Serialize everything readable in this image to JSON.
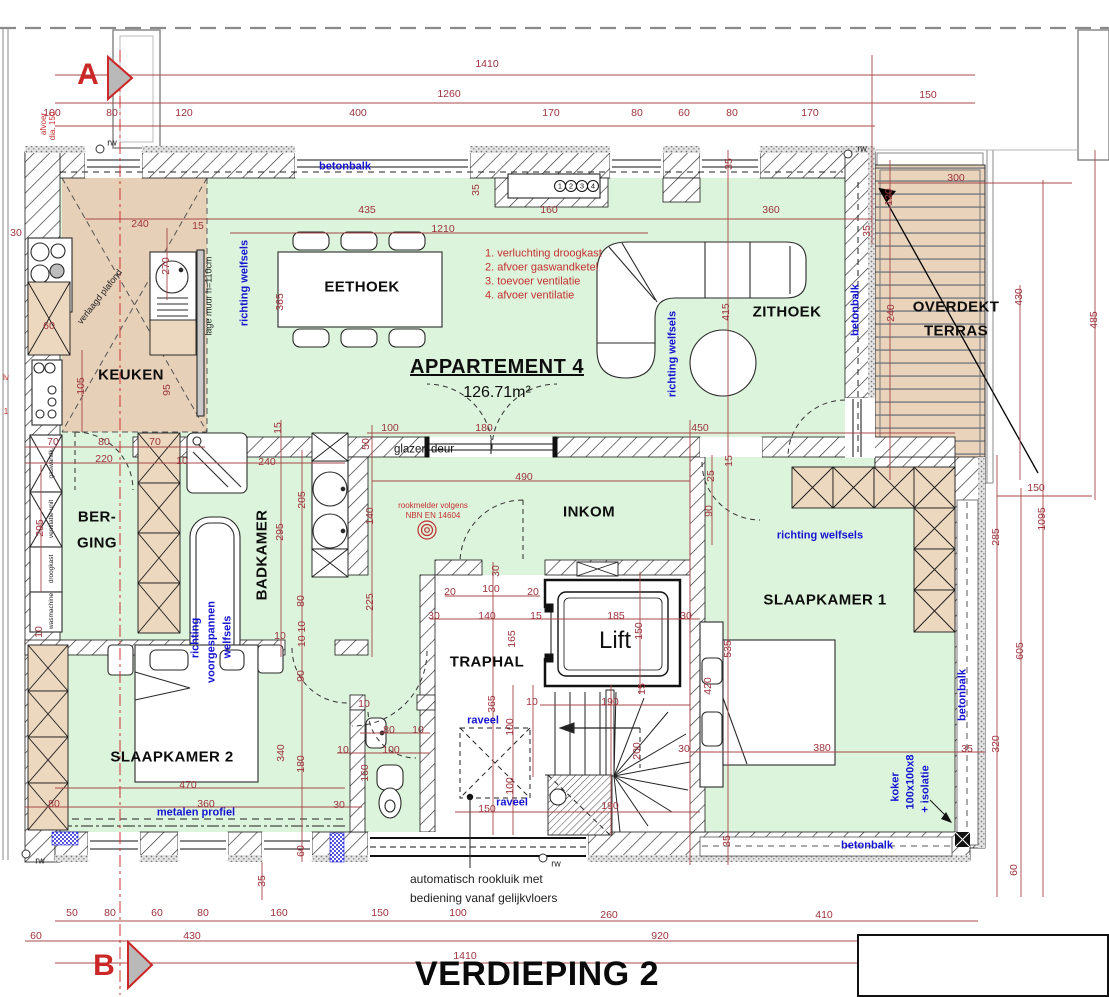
{
  "title": "VERDIEPING 2",
  "apartment": {
    "name": "APPARTEMENT 4",
    "area": "126.71m²"
  },
  "colors": {
    "dim_red": "#9d323c",
    "note_blue": "#1414d2",
    "room_green": "#dcf3dc",
    "cabinet_tan": "#ecd7bf",
    "marker_red": "#cc2727",
    "terrace_tan": "#e9d3bb"
  },
  "rooms": [
    "KEUKEN",
    "EETHOEK",
    "ZITHOEK",
    "BERGING",
    "BADKAMER",
    "INKOM",
    "TRAPHAL",
    "SLAAPKAMER 1",
    "SLAAPKAMER 2",
    "OVERDEKT TERRAS",
    "Lift"
  ],
  "legend_red": [
    "1. verluchting droogkast",
    "2. afvoer gaswandketel",
    "3. toevoer ventilatie",
    "4. afvoer ventilatie"
  ],
  "labels": [
    {
      "t": "1410",
      "x": 487,
      "y": 64,
      "c": "d"
    },
    {
      "t": "1260",
      "x": 449,
      "y": 94,
      "c": "d"
    },
    {
      "t": "150",
      "x": 928,
      "y": 95,
      "c": "d"
    },
    {
      "t": "100",
      "x": 52,
      "y": 113,
      "c": "d"
    },
    {
      "t": "80",
      "x": 112,
      "y": 113,
      "c": "d"
    },
    {
      "t": "120",
      "x": 184,
      "y": 113,
      "c": "d"
    },
    {
      "t": "400",
      "x": 358,
      "y": 113,
      "c": "d"
    },
    {
      "t": "170",
      "x": 551,
      "y": 113,
      "c": "d"
    },
    {
      "t": "80",
      "x": 637,
      "y": 113,
      "c": "d"
    },
    {
      "t": "60",
      "x": 684,
      "y": 113,
      "c": "d"
    },
    {
      "t": "80",
      "x": 732,
      "y": 113,
      "c": "d"
    },
    {
      "t": "170",
      "x": 810,
      "y": 113,
      "c": "d"
    },
    {
      "t": "240",
      "x": 140,
      "y": 224,
      "c": "d"
    },
    {
      "t": "15",
      "x": 198,
      "y": 226,
      "c": "d"
    },
    {
      "t": "435",
      "x": 367,
      "y": 210,
      "c": "d"
    },
    {
      "t": "160",
      "x": 549,
      "y": 210,
      "c": "d"
    },
    {
      "t": "360",
      "x": 771,
      "y": 210,
      "c": "d"
    },
    {
      "t": "1210",
      "x": 443,
      "y": 229,
      "c": "d"
    },
    {
      "t": "300",
      "x": 956,
      "y": 178,
      "c": "d"
    },
    {
      "t": "35",
      "x": 476,
      "y": 190,
      "r": -90,
      "c": "d"
    },
    {
      "t": "35",
      "x": 729,
      "y": 164,
      "r": -90,
      "c": "d"
    },
    {
      "t": "35",
      "x": 867,
      "y": 231,
      "r": -90,
      "c": "d"
    },
    {
      "t": "120",
      "x": 889,
      "y": 197,
      "r": -90,
      "c": "d"
    },
    {
      "t": "240",
      "x": 891,
      "y": 313,
      "r": -90,
      "c": "d"
    },
    {
      "t": "430",
      "x": 1019,
      "y": 297,
      "r": -90,
      "c": "d"
    },
    {
      "t": "485",
      "x": 1094,
      "y": 320,
      "r": -90,
      "c": "d"
    },
    {
      "t": "270",
      "x": 166,
      "y": 266,
      "r": -90,
      "c": "d"
    },
    {
      "t": "365",
      "x": 280,
      "y": 302,
      "r": -90,
      "c": "d"
    },
    {
      "t": "30",
      "x": 16,
      "y": 233,
      "c": "d"
    },
    {
      "t": "60",
      "x": 49,
      "y": 326,
      "c": "d"
    },
    {
      "t": "105",
      "x": 81,
      "y": 386,
      "r": -90,
      "c": "d"
    },
    {
      "t": "95",
      "x": 167,
      "y": 390,
      "r": -90,
      "c": "d"
    },
    {
      "t": "415",
      "x": 726,
      "y": 312,
      "r": -90,
      "c": "d"
    },
    {
      "t": "450",
      "x": 700,
      "y": 428,
      "c": "d"
    },
    {
      "t": "490",
      "x": 524,
      "y": 477,
      "c": "d"
    },
    {
      "t": "50",
      "x": 366,
      "y": 444,
      "r": -90,
      "c": "d"
    },
    {
      "t": "100",
      "x": 390,
      "y": 428,
      "c": "d"
    },
    {
      "t": "180",
      "x": 484,
      "y": 428,
      "c": "d"
    },
    {
      "t": "70",
      "x": 53,
      "y": 442,
      "c": "d"
    },
    {
      "t": "80",
      "x": 104,
      "y": 442,
      "c": "d"
    },
    {
      "t": "70",
      "x": 155,
      "y": 442,
      "c": "d"
    },
    {
      "t": "220",
      "x": 104,
      "y": 459,
      "c": "d"
    },
    {
      "t": "10",
      "x": 182,
      "y": 461,
      "c": "d"
    },
    {
      "t": "240",
      "x": 267,
      "y": 462,
      "c": "d"
    },
    {
      "t": "295",
      "x": 40,
      "y": 528,
      "r": -90,
      "c": "d"
    },
    {
      "t": "15",
      "x": 278,
      "y": 428,
      "r": -90,
      "c": "d"
    },
    {
      "t": "205",
      "x": 302,
      "y": 500,
      "r": -90,
      "c": "d"
    },
    {
      "t": "295",
      "x": 280,
      "y": 532,
      "r": -90,
      "c": "d"
    },
    {
      "t": "140",
      "x": 370,
      "y": 516,
      "r": -90,
      "c": "d"
    },
    {
      "t": "225",
      "x": 370,
      "y": 602,
      "r": -90,
      "c": "d"
    },
    {
      "t": "15",
      "x": 729,
      "y": 461,
      "r": -90,
      "c": "d"
    },
    {
      "t": "25",
      "x": 711,
      "y": 476,
      "r": -90,
      "c": "d"
    },
    {
      "t": "90",
      "x": 709,
      "y": 511,
      "r": -90,
      "c": "d"
    },
    {
      "t": "30",
      "x": 496,
      "y": 571,
      "r": -90,
      "c": "d"
    },
    {
      "t": "20",
      "x": 450,
      "y": 592,
      "c": "d"
    },
    {
      "t": "100",
      "x": 491,
      "y": 589,
      "c": "d"
    },
    {
      "t": "20",
      "x": 533,
      "y": 592,
      "c": "d"
    },
    {
      "t": "30",
      "x": 434,
      "y": 616,
      "c": "d"
    },
    {
      "t": "140",
      "x": 487,
      "y": 616,
      "c": "d"
    },
    {
      "t": "15",
      "x": 536,
      "y": 616,
      "c": "d"
    },
    {
      "t": "185",
      "x": 616,
      "y": 616,
      "c": "d"
    },
    {
      "t": "30",
      "x": 686,
      "y": 616,
      "c": "d"
    },
    {
      "t": "150",
      "x": 639,
      "y": 631,
      "r": -90,
      "c": "d"
    },
    {
      "t": "165",
      "x": 512,
      "y": 639,
      "r": -90,
      "c": "d"
    },
    {
      "t": "365",
      "x": 492,
      "y": 704,
      "r": -90,
      "c": "d"
    },
    {
      "t": "10",
      "x": 532,
      "y": 702,
      "c": "d"
    },
    {
      "t": "190",
      "x": 610,
      "y": 702,
      "c": "d"
    },
    {
      "t": "15",
      "x": 642,
      "y": 689,
      "r": -90,
      "c": "d"
    },
    {
      "t": "100",
      "x": 510,
      "y": 727,
      "r": -90,
      "c": "d"
    },
    {
      "t": "100",
      "x": 510,
      "y": 786,
      "r": -90,
      "c": "d"
    },
    {
      "t": "150",
      "x": 487,
      "y": 809,
      "c": "d"
    },
    {
      "t": "190",
      "x": 610,
      "y": 806,
      "c": "d"
    },
    {
      "t": "200",
      "x": 637,
      "y": 751,
      "r": -90,
      "c": "d"
    },
    {
      "t": "30",
      "x": 684,
      "y": 749,
      "c": "d"
    },
    {
      "t": "80",
      "x": 301,
      "y": 601,
      "r": -90,
      "c": "d"
    },
    {
      "t": "10",
      "x": 280,
      "y": 636,
      "c": "d"
    },
    {
      "t": "10 10",
      "x": 302,
      "y": 634,
      "r": -90,
      "c": "d"
    },
    {
      "t": "90",
      "x": 301,
      "y": 676,
      "r": -90,
      "c": "d"
    },
    {
      "t": "10",
      "x": 39,
      "y": 632,
      "r": -90,
      "c": "d"
    },
    {
      "t": "535",
      "x": 728,
      "y": 649,
      "r": -90,
      "c": "d"
    },
    {
      "t": "420",
      "x": 708,
      "y": 686,
      "r": -90,
      "c": "d"
    },
    {
      "t": "380",
      "x": 822,
      "y": 748,
      "c": "d"
    },
    {
      "t": "35",
      "x": 727,
      "y": 841,
      "r": -90,
      "c": "d"
    },
    {
      "t": "320",
      "x": 996,
      "y": 744,
      "r": -90,
      "c": "d"
    },
    {
      "t": "285",
      "x": 996,
      "y": 537,
      "r": -90,
      "c": "d"
    },
    {
      "t": "605",
      "x": 1020,
      "y": 651,
      "r": -90,
      "c": "d"
    },
    {
      "t": "1095",
      "x": 1042,
      "y": 519,
      "r": -90,
      "c": "d"
    },
    {
      "t": "150",
      "x": 1036,
      "y": 488,
      "c": "d"
    },
    {
      "t": "60",
      "x": 1014,
      "y": 870,
      "r": -90,
      "c": "d"
    },
    {
      "t": "35",
      "x": 967,
      "y": 749,
      "c": "d"
    },
    {
      "t": "10",
      "x": 364,
      "y": 704,
      "c": "d"
    },
    {
      "t": "80",
      "x": 389,
      "y": 730,
      "c": "d"
    },
    {
      "t": "10",
      "x": 418,
      "y": 730,
      "c": "d"
    },
    {
      "t": "10",
      "x": 343,
      "y": 750,
      "c": "d"
    },
    {
      "t": "100",
      "x": 391,
      "y": 750,
      "c": "d"
    },
    {
      "t": "160",
      "x": 365,
      "y": 773,
      "r": -90,
      "c": "d"
    },
    {
      "t": "30",
      "x": 339,
      "y": 805,
      "c": "d"
    },
    {
      "t": "470",
      "x": 188,
      "y": 785,
      "c": "d"
    },
    {
      "t": "360",
      "x": 206,
      "y": 804,
      "c": "d"
    },
    {
      "t": "80",
      "x": 54,
      "y": 804,
      "c": "d"
    },
    {
      "t": "340",
      "x": 281,
      "y": 753,
      "r": -90,
      "c": "d"
    },
    {
      "t": "180",
      "x": 301,
      "y": 764,
      "r": -90,
      "c": "d"
    },
    {
      "t": "60",
      "x": 301,
      "y": 851,
      "r": -90,
      "c": "d"
    },
    {
      "t": "50",
      "x": 72,
      "y": 913,
      "c": "d"
    },
    {
      "t": "80",
      "x": 110,
      "y": 913,
      "c": "d"
    },
    {
      "t": "60",
      "x": 157,
      "y": 913,
      "c": "d"
    },
    {
      "t": "80",
      "x": 203,
      "y": 913,
      "c": "d"
    },
    {
      "t": "160",
      "x": 279,
      "y": 913,
      "c": "d"
    },
    {
      "t": "150",
      "x": 380,
      "y": 913,
      "c": "d"
    },
    {
      "t": "100",
      "x": 458,
      "y": 913,
      "c": "d"
    },
    {
      "t": "260",
      "x": 609,
      "y": 915,
      "c": "d"
    },
    {
      "t": "410",
      "x": 824,
      "y": 915,
      "c": "d"
    },
    {
      "t": "60",
      "x": 36,
      "y": 936,
      "c": "d"
    },
    {
      "t": "430",
      "x": 192,
      "y": 936,
      "c": "d"
    },
    {
      "t": "920",
      "x": 660,
      "y": 936,
      "c": "d"
    },
    {
      "t": "1410",
      "x": 465,
      "y": 956,
      "c": "d"
    },
    {
      "t": "35",
      "x": 262,
      "y": 881,
      "r": -90,
      "c": "d"
    },
    {
      "t": "betonbalk",
      "x": 345,
      "y": 167,
      "c": "b"
    },
    {
      "t": "betonbalk",
      "x": 856,
      "y": 310,
      "r": -90,
      "c": "b"
    },
    {
      "t": "betonbalk",
      "x": 963,
      "y": 695,
      "r": -90,
      "c": "b"
    },
    {
      "t": "betonbalk",
      "x": 867,
      "y": 846,
      "c": "b"
    },
    {
      "t": "richting welfsels",
      "x": 245,
      "y": 283,
      "r": -90,
      "c": "b"
    },
    {
      "t": "richting welfsels",
      "x": 673,
      "y": 354,
      "r": -90,
      "c": "b"
    },
    {
      "t": "richting welfsels",
      "x": 820,
      "y": 536,
      "c": "b"
    },
    {
      "t": "richting",
      "x": 196,
      "y": 638,
      "r": -90,
      "c": "b"
    },
    {
      "t": "voorgespannen",
      "x": 212,
      "y": 642,
      "r": -90,
      "c": "b"
    },
    {
      "t": "welfsels",
      "x": 228,
      "y": 637,
      "r": -90,
      "c": "b"
    },
    {
      "t": "metalen profiel",
      "x": 196,
      "y": 813,
      "c": "b"
    },
    {
      "t": "raveel",
      "x": 483,
      "y": 721,
      "c": "b"
    },
    {
      "t": "raveel",
      "x": 512,
      "y": 803,
      "c": "b"
    },
    {
      "t": "koker",
      "x": 896,
      "y": 787,
      "r": -90,
      "c": "b"
    },
    {
      "t": "100x100x8",
      "x": 911,
      "y": 782,
      "r": -90,
      "c": "b"
    },
    {
      "t": "+ isolatie",
      "x": 926,
      "y": 789,
      "r": -90,
      "c": "b"
    },
    {
      "t": "KEUKEN",
      "x": 131,
      "y": 375,
      "c": "r"
    },
    {
      "t": "EETHOEK",
      "x": 362,
      "y": 287,
      "c": "r"
    },
    {
      "t": "ZITHOEK",
      "x": 787,
      "y": 312,
      "c": "r"
    },
    {
      "t": "BER-",
      "x": 97,
      "y": 517,
      "c": "r"
    },
    {
      "t": "GING",
      "x": 97,
      "y": 543,
      "c": "r"
    },
    {
      "t": "BADKAMER",
      "x": 262,
      "y": 555,
      "r": -90,
      "c": "r"
    },
    {
      "t": "INKOM",
      "x": 589,
      "y": 512,
      "c": "r"
    },
    {
      "t": "TRAPHAL",
      "x": 487,
      "y": 662,
      "c": "r"
    },
    {
      "t": "SLAAPKAMER 1",
      "x": 825,
      "y": 600,
      "c": "r"
    },
    {
      "t": "SLAAPKAMER 2",
      "x": 172,
      "y": 757,
      "c": "r"
    },
    {
      "t": "OVERDEKT",
      "x": 956,
      "y": 307,
      "c": "r"
    },
    {
      "t": "TERRAS",
      "x": 956,
      "y": 331,
      "c": "r"
    },
    {
      "t": "Lift",
      "x": 615,
      "y": 641,
      "c": "lift"
    },
    {
      "t": "A",
      "x": 88,
      "y": 75,
      "c": "ab"
    },
    {
      "t": "B",
      "x": 104,
      "y": 966,
      "c": "ab"
    },
    {
      "t": "1. verluchting droogkast",
      "x": 485,
      "y": 254,
      "c": "rn"
    },
    {
      "t": "2. afvoer gaswandketel",
      "x": 485,
      "y": 268,
      "c": "rn"
    },
    {
      "t": "3. toevoer ventilatie",
      "x": 485,
      "y": 282,
      "c": "rn"
    },
    {
      "t": "4. afvoer ventilatie",
      "x": 485,
      "y": 296,
      "c": "rn"
    },
    {
      "t": "rookmelder volgens",
      "x": 433,
      "y": 506,
      "c": "rs"
    },
    {
      "t": "NBN EN 14604",
      "x": 433,
      "y": 516,
      "c": "rs"
    },
    {
      "t": "afvoer",
      "x": 44,
      "y": 124,
      "r": -90,
      "c": "rs"
    },
    {
      "t": "dia. 150",
      "x": 53,
      "y": 126,
      "r": -90,
      "c": "rs"
    },
    {
      "t": "lv",
      "x": 6,
      "y": 378,
      "c": "rs"
    },
    {
      "t": "1",
      "x": 6,
      "y": 412,
      "c": "rs"
    },
    {
      "t": "glazen deur",
      "x": 424,
      "y": 450,
      "c": "s"
    },
    {
      "t": "lage muur h=110cm",
      "x": 209,
      "y": 296,
      "r": -90,
      "c": "xs"
    },
    {
      "t": "verlaagd plafond",
      "x": 100,
      "y": 297,
      "r": -52,
      "c": "xs"
    },
    {
      "t": "rw",
      "x": 112,
      "y": 143,
      "c": "xs"
    },
    {
      "t": "rw",
      "x": 862,
      "y": 149,
      "c": "xs"
    },
    {
      "t": "rw",
      "x": 40,
      "y": 861,
      "c": "xs"
    },
    {
      "t": "rw",
      "x": 556,
      "y": 864,
      "c": "xs"
    },
    {
      "t": "automatisch rookluik met",
      "x": 410,
      "y": 879,
      "c": "sl"
    },
    {
      "t": "bediening vanaf gelijkvloers",
      "x": 410,
      "y": 898,
      "c": "sl"
    },
    {
      "t": "gaswandk.",
      "x": 52,
      "y": 463,
      "r": -90,
      "c": "vt"
    },
    {
      "t": "ventilatie-unit",
      "x": 52,
      "y": 519,
      "r": -90,
      "c": "vt"
    },
    {
      "t": "droogkast",
      "x": 52,
      "y": 569,
      "r": -90,
      "c": "vt"
    },
    {
      "t": "wasmachine",
      "x": 52,
      "y": 611,
      "r": -90,
      "c": "vt"
    },
    {
      "t": "1",
      "x": 560,
      "y": 186,
      "c": "cn"
    },
    {
      "t": "2",
      "x": 571,
      "y": 186,
      "c": "cn"
    },
    {
      "t": "3",
      "x": 582,
      "y": 186,
      "c": "cn"
    },
    {
      "t": "4",
      "x": 593,
      "y": 186,
      "c": "cn"
    }
  ]
}
